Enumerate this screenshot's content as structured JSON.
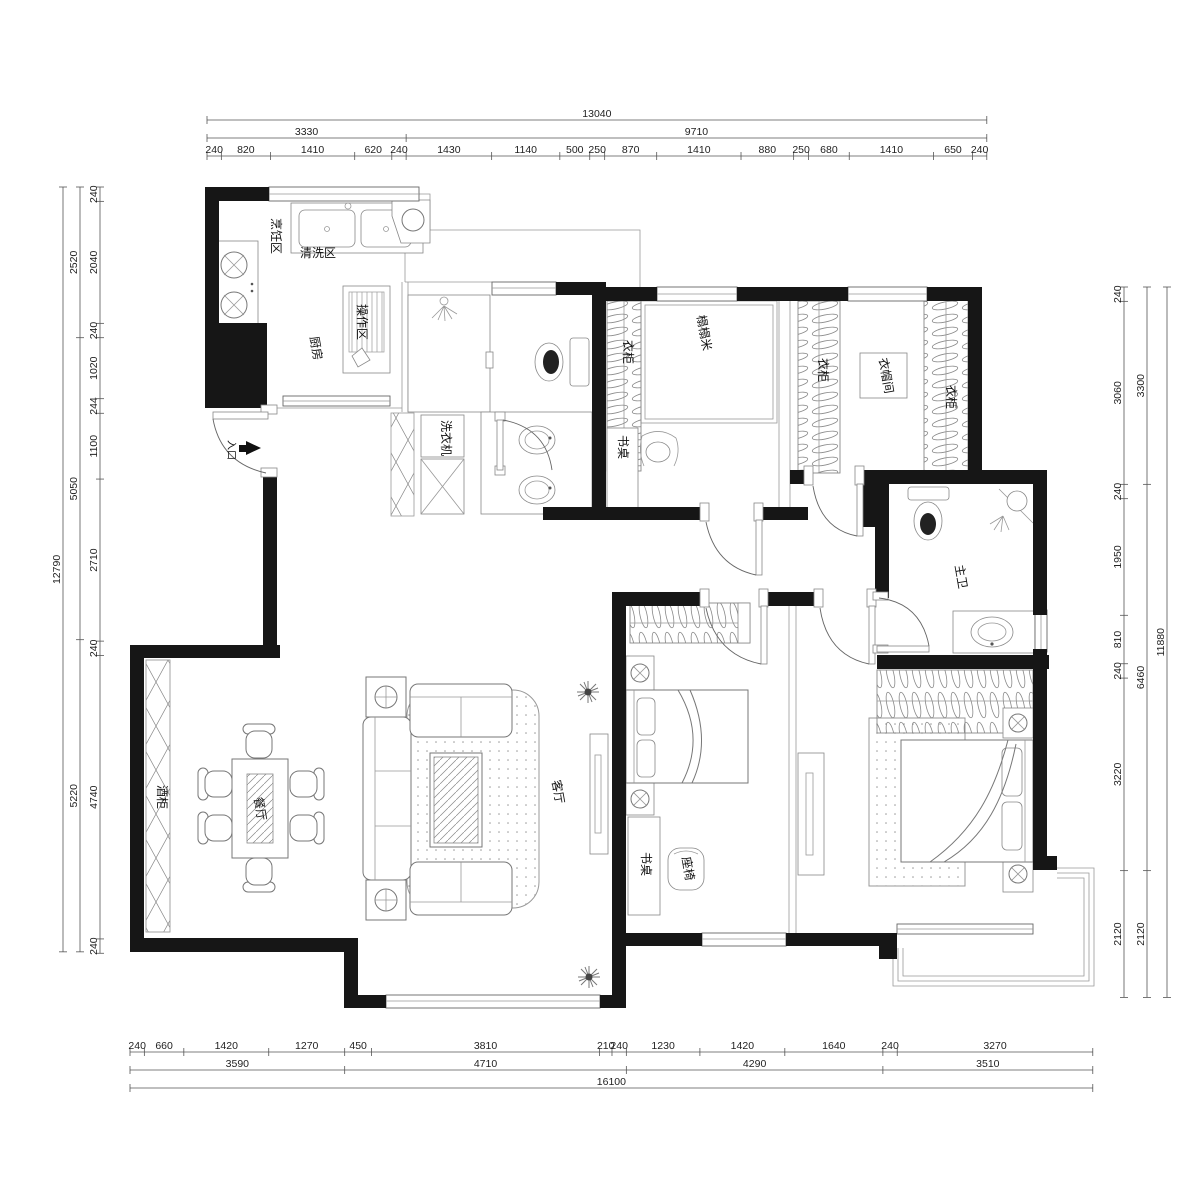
{
  "labels": {
    "kitchen": "厨房",
    "wash_zone": "清洗区",
    "cook_zone": "烹饪区",
    "prep_zone": "操作区",
    "entrance": "入口",
    "washer": "洗衣机",
    "tatami": "榻榻米",
    "wardrobe_a": "衣柜",
    "desk_a": "书桌",
    "wardrobe_b": "衣柜",
    "cloakroom": "衣帽间",
    "wardrobe_c": "衣柜",
    "master_bath": "主卫",
    "wine_cabinet": "酒柜",
    "dining": "餐厅",
    "living": "客厅",
    "desk_b": "书桌",
    "chair": "座椅"
  },
  "dimensions": {
    "scale": 0.0598,
    "top": {
      "origin": 207,
      "rows": [
        {
          "pos": 120,
          "values": [
            13040
          ]
        },
        {
          "pos": 138,
          "values": [
            3330,
            9710
          ]
        },
        {
          "pos": 156,
          "values": [
            240,
            820,
            1410,
            620,
            240,
            1430,
            1140,
            500,
            250,
            870,
            1410,
            880,
            250,
            680,
            1410,
            650,
            240
          ]
        }
      ]
    },
    "bottom": {
      "origin": 130,
      "rows": [
        {
          "pos": 1052,
          "values": [
            240,
            660,
            1420,
            1270,
            450,
            3810,
            210,
            240,
            1230,
            1420,
            1640,
            240,
            3270
          ]
        },
        {
          "pos": 1070,
          "values": [
            3590,
            4710,
            4290,
            3510
          ]
        },
        {
          "pos": 1088,
          "values": [
            16100
          ]
        }
      ]
    },
    "left": {
      "origin": 187,
      "rows": [
        {
          "pos": 100,
          "values": [
            240,
            2040,
            240,
            1020,
            244,
            1100,
            2710,
            240,
            4740,
            240
          ]
        },
        {
          "pos": 80,
          "values": [
            2520,
            5050,
            5220
          ]
        },
        {
          "pos": 63,
          "values": [
            12790
          ]
        }
      ]
    },
    "right": {
      "origin": 287,
      "rows": [
        {
          "pos": 1124,
          "values": [
            240,
            3060,
            240,
            1950,
            810,
            240,
            3220,
            2120
          ]
        },
        {
          "pos": 1147,
          "values": [
            3300,
            6460,
            2120
          ]
        },
        {
          "pos": 1167,
          "values": [
            11880
          ]
        }
      ]
    }
  }
}
